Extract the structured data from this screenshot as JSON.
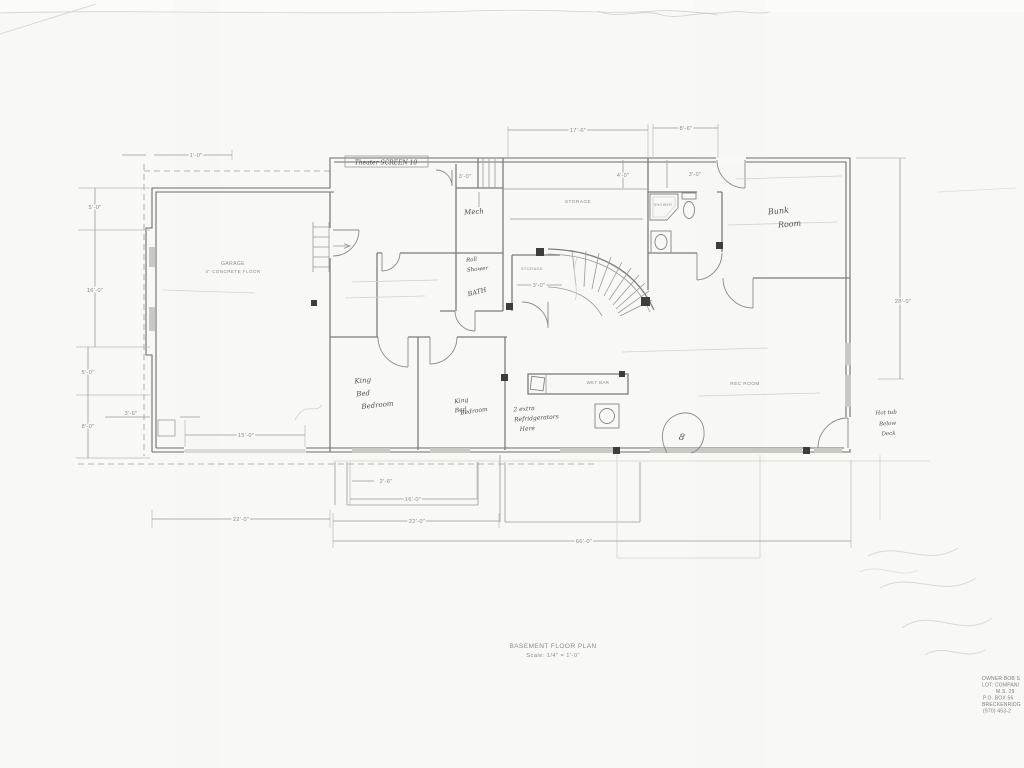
{
  "plan": {
    "title": "BASEMENT FLOOR PLAN",
    "scale_note": "Scale: 1/4\" = 1'-0\"",
    "rooms": {
      "garage": "GARAGE",
      "garage_note": "4\" CONCRETE FLOOR",
      "storage_main": "STORAGE",
      "storage_under_stairs": "STORAGE",
      "shower": "SHOWER",
      "wet_bar": "WET BAR",
      "rec_room": "REC ROOM"
    },
    "handwritten": {
      "theater_screen": "Theater  SCREEN  10",
      "mech": "Mech",
      "roll_shower_1": "Roll",
      "roll_shower_2": "Shower",
      "bath": "BATH",
      "bunk_room_1": "Bunk",
      "bunk_room_2": "Room",
      "king1_1": "King",
      "king1_2": "Bed",
      "king1_3": "Bedroom",
      "king2_1": "King",
      "king2_2": "Bed",
      "king2_3": "Bedroom",
      "fridge_1": "2 extra",
      "fridge_2": "Refridgerators",
      "fridge_3": "Here",
      "hottub_1": "Hot tub",
      "hottub_2": "Below",
      "hottub_3": "Deck",
      "fireplace_mark": "8"
    },
    "dimensions": {
      "top_storage": "17'-6\"",
      "top_bunk": "8'-6\"",
      "left_jog": "1'-0\"",
      "left_upper": "5'-0\"",
      "left_mid": "16'-0\"",
      "left_lower": "5'-0\"",
      "left_bottom": "8'-0\"",
      "garage_pier": "3'-6\"",
      "garage_door": "15'-0\"",
      "mech_chase": "3'-0\"",
      "storage_shelf": "4'-0\"",
      "vestibule": "3'-0\"",
      "stair_closet": "3'-0\"",
      "right_depth": "28'-0\"",
      "bottom_jog": "2'-6\"",
      "bottom_bed": "16'-0\"",
      "bottom_garage": "22'-0\"",
      "bottom_bed_total": "22'-0\"",
      "bottom_total": "66'-0\""
    }
  },
  "owner_block": {
    "line1": "OWNER:BOB S",
    "line2": "LOT: COMPANI",
    "line3": "M.S. 29",
    "line4": "P.O. BOX 56",
    "line5": "BRECKENRIDG",
    "line6": "(970) 453-2"
  }
}
